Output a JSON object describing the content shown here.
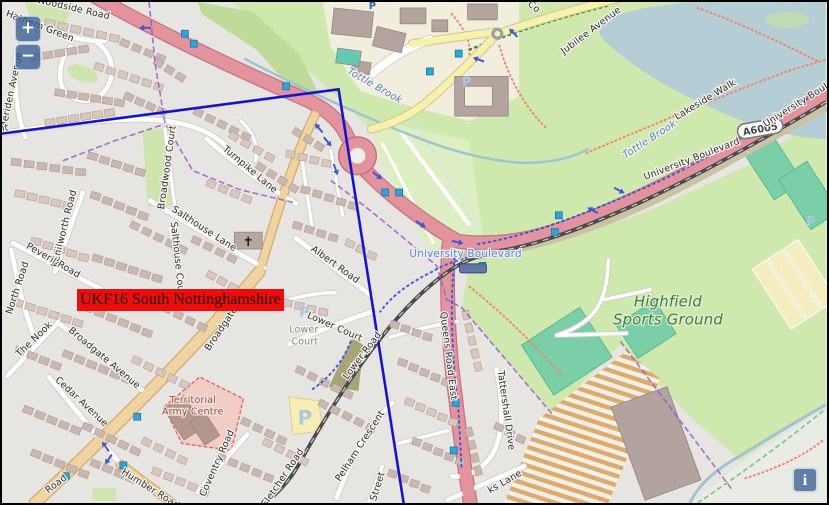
{
  "region_overlay": {
    "label": "UKF16 South Nottinghamshire",
    "box_color": "#ee0d0d"
  },
  "controls": {
    "zoom_in": "+",
    "zoom_out": "−",
    "info": "i"
  },
  "colors": {
    "overlay_polygon": "#1414cc",
    "primary_road": "#e2939d",
    "secondary_road": "#f0d3a2",
    "minor_road_yellow": "#f6f1ae",
    "park_green": "#cfe8ae",
    "pitch_teal": "#7bcfa8",
    "water": "#b5cdd5",
    "marker_blue": "#31a3d4",
    "boundary_purple": "#9b59c8",
    "label_red_bg": "#ee0d0d"
  },
  "map": {
    "labels": [
      {
        "text": "Woodside Road",
        "x": 70,
        "y": 9,
        "rot": 13,
        "cls": "road"
      },
      {
        "text": "Hathern Green",
        "x": 36,
        "y": 27,
        "rot": 21,
        "cls": "road"
      },
      {
        "text": "Meriden Avenue",
        "x": 11,
        "y": 90,
        "rot": -78,
        "cls": "road"
      },
      {
        "text": "Crescent",
        "x": -16,
        "y": 132,
        "rot": -7,
        "cls": "road"
      },
      {
        "text": "Broadwood Court",
        "x": 168,
        "y": 167,
        "rot": -82,
        "cls": "road"
      },
      {
        "text": "Turnpike Lane",
        "x": 247,
        "y": 171,
        "rot": 40,
        "cls": "road"
      },
      {
        "text": "Salthouse Lane",
        "x": 201,
        "y": 231,
        "rot": 33,
        "cls": "road"
      },
      {
        "text": "Salthouse Court",
        "x": 173,
        "y": 261,
        "rot": 84,
        "cls": "road"
      },
      {
        "text": "Kenilworth Road",
        "x": 64,
        "y": 229,
        "rot": -76,
        "cls": "road"
      },
      {
        "text": "Peveril Road",
        "x": 49,
        "y": 263,
        "rot": 30,
        "cls": "road"
      },
      {
        "text": "North Road",
        "x": 17,
        "y": 289,
        "rot": -72,
        "cls": "road"
      },
      {
        "text": "The Nook",
        "x": 33,
        "y": 342,
        "rot": -44,
        "cls": "road"
      },
      {
        "text": "Broadgate Avenue",
        "x": 100,
        "y": 361,
        "rot": 40,
        "cls": "road"
      },
      {
        "text": "Cedar Avenue",
        "x": 77,
        "y": 405,
        "rot": 43,
        "cls": "road"
      },
      {
        "text": "Broadgate",
        "x": 222,
        "y": 331,
        "rot": -56,
        "cls": "road"
      },
      {
        "text": "Albert Road",
        "x": 333,
        "y": 267,
        "rot": 36,
        "cls": "road"
      },
      {
        "text": "Lower Court",
        "x": 333,
        "y": 330,
        "rot": 24,
        "cls": "road"
      },
      {
        "text": "Lower",
        "x": 303,
        "y": 333,
        "rot": 0,
        "cls": "area"
      },
      {
        "text": "Court",
        "x": 304,
        "y": 345,
        "rot": 0,
        "cls": "area"
      },
      {
        "text": "Lower Road",
        "x": 364,
        "y": 358,
        "rot": -53,
        "cls": "road"
      },
      {
        "text": "Fletcher Road",
        "x": 284,
        "y": 481,
        "rot": -56,
        "cls": "road"
      },
      {
        "text": "Pelham Crescent",
        "x": 362,
        "y": 449,
        "rot": -57,
        "cls": "road"
      },
      {
        "text": "Street",
        "x": 380,
        "y": 489,
        "rot": -73,
        "cls": "road"
      },
      {
        "text": "Queens Road East",
        "x": 446,
        "y": 357,
        "rot": 83,
        "cls": "road"
      },
      {
        "text": "Tattershall Drive",
        "x": 504,
        "y": 412,
        "rot": 82,
        "cls": "road"
      },
      {
        "text": "ks Lane",
        "x": 507,
        "y": 486,
        "rot": -30,
        "cls": "road"
      },
      {
        "text": "Territorial",
        "x": 191,
        "y": 404,
        "rot": 0,
        "cls": "military"
      },
      {
        "text": "Army Centre",
        "x": 191,
        "y": 416,
        "rot": 0,
        "cls": "military"
      },
      {
        "text": "Coventry Road",
        "x": 218,
        "y": 466,
        "rot": -66,
        "cls": "road"
      },
      {
        "text": "Humber Road",
        "x": 147,
        "y": 493,
        "rot": 32,
        "cls": "road"
      },
      {
        "text": "Road",
        "x": 55,
        "y": 488,
        "rot": -38,
        "cls": "road"
      },
      {
        "text": "University Boulevard",
        "x": 695,
        "y": 161,
        "rot": -21,
        "cls": "road",
        "size": 10
      },
      {
        "text": "University Boulevard",
        "x": 812,
        "y": 99,
        "rot": -32,
        "cls": "road",
        "size": 10
      },
      {
        "text": "University Boulevard",
        "x": 466,
        "y": 257,
        "rot": 0,
        "cls": "transit"
      },
      {
        "text": "Tottle Brook",
        "x": 373,
        "y": 87,
        "rot": 30,
        "cls": "water"
      },
      {
        "text": "Tottle Brook",
        "x": 653,
        "y": 141,
        "rot": -33,
        "cls": "water"
      },
      {
        "text": "Lakeside Walk",
        "x": 709,
        "y": 101,
        "rot": -31,
        "cls": "road"
      },
      {
        "text": "Jubilee Avenue",
        "x": 594,
        "y": 31,
        "rot": -37,
        "cls": "road"
      },
      {
        "text": "Co",
        "x": 533,
        "y": 7,
        "rot": 40,
        "cls": "road"
      },
      {
        "text": "Highfield",
        "x": 670,
        "y": 307,
        "rot": 0,
        "cls": "green"
      },
      {
        "text": "Sports Ground",
        "x": 670,
        "y": 325,
        "rot": 0,
        "cls": "green"
      }
    ],
    "route_badge": {
      "text": "A6005",
      "x": 763,
      "y": 128,
      "rot": -10
    },
    "markers": [
      [
        183,
        32
      ],
      [
        192,
        42
      ],
      [
        285,
        85
      ],
      [
        430,
        70
      ],
      [
        459,
        52
      ],
      [
        385,
        192
      ],
      [
        399,
        192
      ],
      [
        560,
        215
      ],
      [
        556,
        232
      ],
      [
        483,
        266
      ],
      [
        456,
        404
      ],
      [
        454,
        452
      ],
      [
        135,
        418
      ],
      [
        121,
        467
      ],
      [
        63,
        478
      ]
    ],
    "oneway_arrows": [
      [
        143,
        26,
        180
      ],
      [
        318,
        127,
        -130
      ],
      [
        327,
        141,
        50
      ],
      [
        335,
        169,
        70
      ],
      [
        377,
        175,
        38
      ],
      [
        421,
        224,
        33
      ],
      [
        458,
        242,
        12
      ],
      [
        479,
        58,
        200
      ],
      [
        514,
        31,
        225
      ],
      [
        594,
        210,
        208
      ],
      [
        621,
        190,
        28
      ],
      [
        103,
        448,
        -125
      ],
      [
        106,
        461,
        125
      ]
    ],
    "parking_icons": [
      {
        "x": 372,
        "y": 7,
        "variant": "blue",
        "glyph": "P"
      },
      {
        "x": 303,
        "y": 317,
        "variant": "pale",
        "glyph": "P"
      },
      {
        "x": 304,
        "y": 426,
        "variant": "pale-lg",
        "glyph": "P"
      },
      {
        "x": 467,
        "y": 85,
        "variant": "pale",
        "glyph": "P"
      },
      {
        "x": 814,
        "y": 226,
        "variant": "pale",
        "glyph": "P"
      }
    ],
    "church_icon": {
      "x": 247,
      "y": 246,
      "glyph": "✝"
    },
    "mini_roundabout_icon": {
      "x": 498,
      "y": 32
    },
    "tram_stop_platform": {
      "x": 460,
      "y": 264
    }
  }
}
